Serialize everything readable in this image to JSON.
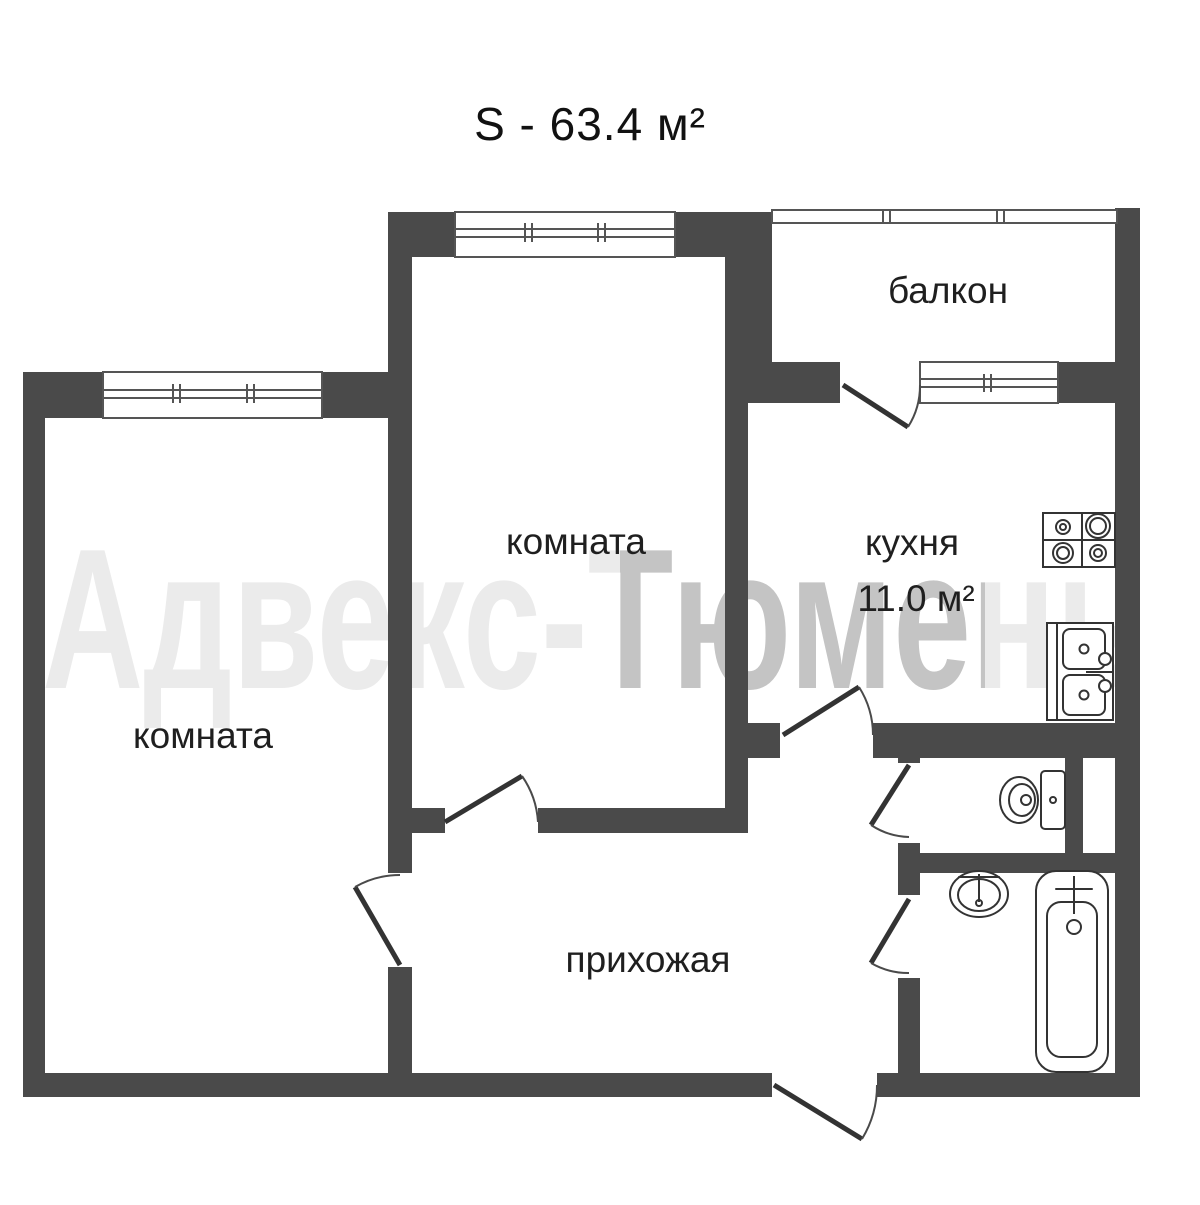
{
  "title": "S - 63.4 м²",
  "watermark": "Адвекс-Тюмень",
  "rooms": {
    "balcony": "балкон",
    "room_middle": "комната",
    "room_left": "комната",
    "kitchen": "кухня",
    "kitchen_area": "11.0 м²",
    "hallway": "прихожая"
  },
  "colors": {
    "wall": "#4a4a4a",
    "leaf": "#333333",
    "thin": "#555555",
    "text": "#1f1f1f",
    "bg": "#ffffff"
  }
}
